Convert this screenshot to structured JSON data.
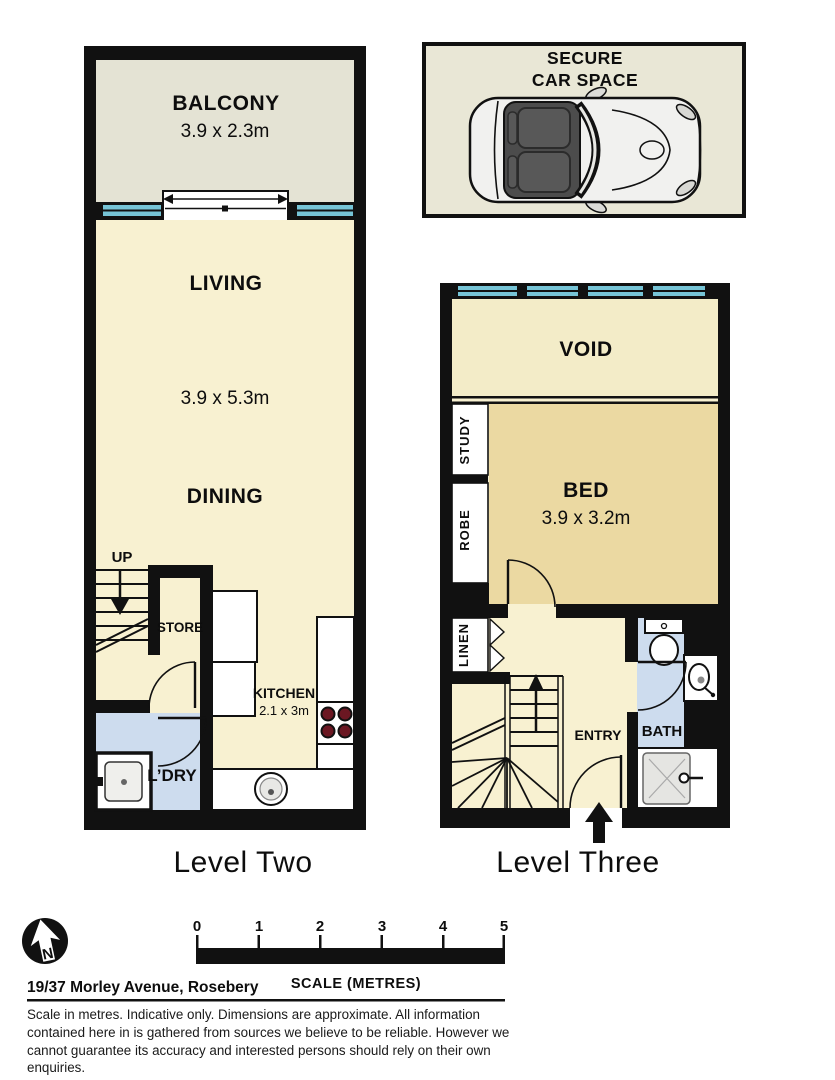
{
  "plans": {
    "level_two": {
      "label": "Level Two",
      "up_label": "UP",
      "rooms": {
        "balcony": {
          "name": "BALCONY",
          "dims": "3.9 x 2.3m"
        },
        "living": {
          "name": "LIVING"
        },
        "living_dining_dims": "3.9 x 5.3m",
        "dining": {
          "name": "DINING"
        },
        "store": {
          "name": "STORE"
        },
        "kitchen": {
          "name": "KITCHEN",
          "dims": "2.1 x 3m"
        },
        "laundry": {
          "name": "L’DRY"
        }
      }
    },
    "car_space": {
      "label_line1": "SECURE",
      "label_line2": "CAR SPACE"
    },
    "level_three": {
      "label": "Level Three",
      "rooms": {
        "void": {
          "name": "VOID"
        },
        "bed": {
          "name": "BED",
          "dims": "3.9 x 3.2m"
        },
        "study": {
          "name": "STUDY"
        },
        "robe": {
          "name": "ROBE"
        },
        "linen": {
          "name": "LINEN"
        },
        "entry": {
          "name": "ENTRY"
        },
        "bath": {
          "name": "BATH"
        }
      }
    }
  },
  "compass": {
    "north_label": "N"
  },
  "scale_bar": {
    "ticks": [
      "0",
      "1",
      "2",
      "3",
      "4",
      "5"
    ],
    "label": "SCALE (METRES)"
  },
  "address": "19/37 Morley Avenue, Rosebery",
  "disclaimer": "Scale in metres. Indicative only. Dimensions are approximate. All information contained here in is gathered from sources we believe to be reliable. However we cannot guarantee its accuracy and interested persons should rely on their own enquiries.",
  "colors": {
    "wall": "#111111",
    "living_cream": "#f8f1d1",
    "void_cream": "#f3ecc8",
    "bed_tan": "#ebd9a2",
    "wet_blue": "#cddcee",
    "window_blue": "#76c4d6",
    "balcony_grey": "#e4e3d4",
    "car_space_bg": "#e9e7d6",
    "burner_red": "#6b1722"
  }
}
